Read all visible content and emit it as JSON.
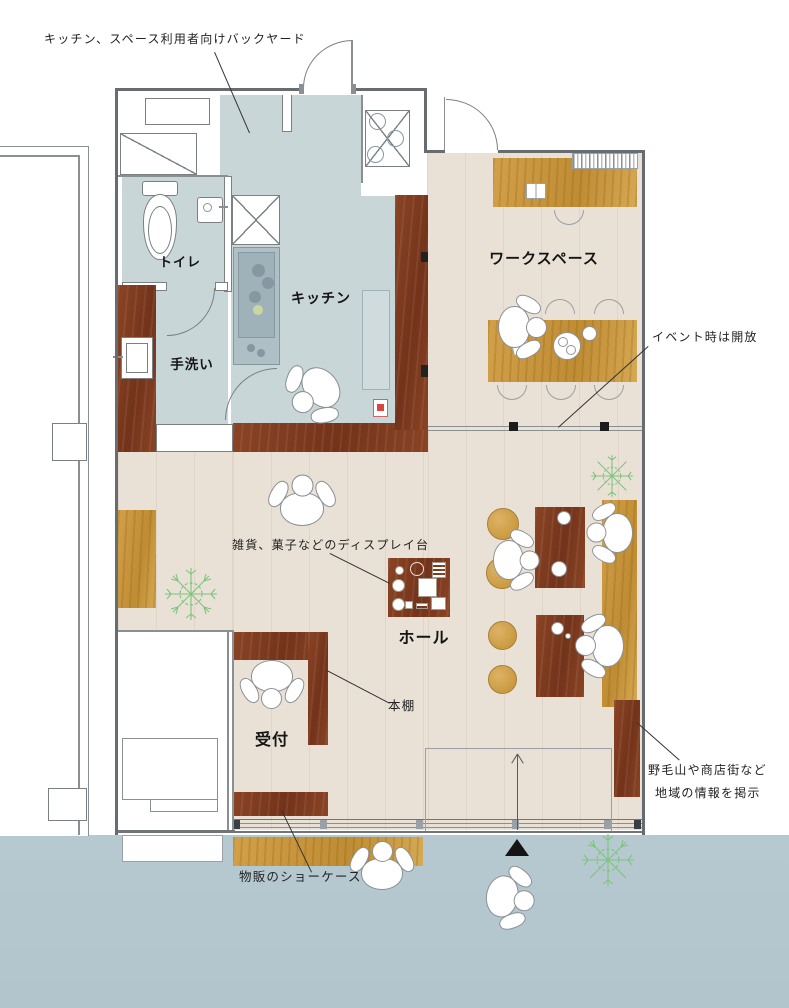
{
  "plan": {
    "rooms": {
      "toilet": "トイレ",
      "handwash": "手洗い",
      "kitchen": "キッチン",
      "workspace": "ワークスペース",
      "hall": "ホール",
      "reception": "受付"
    },
    "annotations": {
      "backyard": "キッチン、スペース利用者向けバックヤード",
      "event_open": "イベント時は開放",
      "display_stand": "雑貨、菓子などのディスプレイ台",
      "bookshelf": "本棚",
      "showcase": "物販のショーケース",
      "local_info_line1": "野毛山や商店街など",
      "local_info_line2": "地域の情報を掲示"
    }
  },
  "colors": {
    "floor_beige": "#eae1d6",
    "wet_zone_blue": "#c9d6d8",
    "sidewalk_blue": "#b6c8cf",
    "wood_dark_brown": "#82401f",
    "wood_golden": "#cc9a42",
    "plant_green": "#7cc47c",
    "wall_line": "#676c70",
    "text": "#141414"
  }
}
